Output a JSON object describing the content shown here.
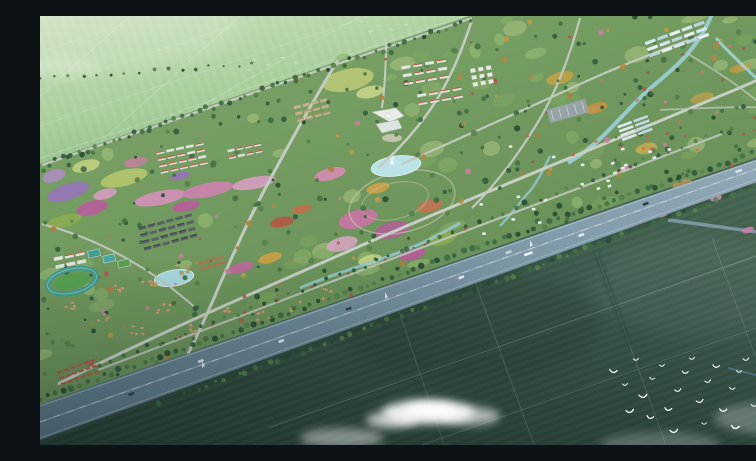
{
  "meta": {
    "title": "Aerial masterplan rendering",
    "description": "Bird's-eye architectural rendering of a large garden community surrounded by farmland, crossed diagonally by a tree-lined highway, with dark crop fields, a flock of white birds and drifting clouds in the foreground."
  },
  "palette": {
    "farmland_light": "#b7d5a5",
    "development_green": "#6f9a5c",
    "field_dark": "#32503f",
    "highway_asphalt": "#7b93a2",
    "water": "#a9dbe0",
    "cloud": "#ffffff",
    "bird": "#f5f8fa",
    "track_teal": "#3f9e8f",
    "roof_red": "#b5563c",
    "roof_dark": "#4a4f55",
    "cottage_tan": "#c8a873",
    "building_white": "#e9ede9",
    "road_light": "#c9cfc3"
  },
  "scene": {
    "clouds": [
      {
        "x": 388,
        "y": 396,
        "rx": 46,
        "ry": 12,
        "o": 0.88
      },
      {
        "x": 390,
        "y": 394,
        "rx": 26,
        "ry": 7,
        "o": 0.95
      },
      {
        "x": 352,
        "y": 404,
        "rx": 26,
        "ry": 8,
        "o": 0.7
      },
      {
        "x": 430,
        "y": 400,
        "rx": 30,
        "ry": 9,
        "o": 0.62
      },
      {
        "x": 302,
        "y": 422,
        "rx": 42,
        "ry": 10,
        "o": 0.42
      },
      {
        "x": 620,
        "y": 428,
        "rx": 60,
        "ry": 12,
        "o": 0.22
      },
      {
        "x": 732,
        "y": 402,
        "rx": 58,
        "ry": 16,
        "o": 0.26
      },
      {
        "x": 20,
        "y": 52,
        "rx": 40,
        "ry": 10,
        "o": 0.18
      }
    ],
    "birds": {
      "flock": [
        [
          573,
          356
        ],
        [
          585,
          369
        ],
        [
          596,
          344
        ],
        [
          603,
          381
        ],
        [
          612,
          363
        ],
        [
          622,
          350
        ],
        [
          628,
          394
        ],
        [
          638,
          375
        ],
        [
          645,
          357
        ],
        [
          652,
          343
        ],
        [
          660,
          386
        ],
        [
          668,
          366
        ],
        [
          676,
          351
        ],
        [
          683,
          395
        ],
        [
          692,
          373
        ],
        [
          699,
          356
        ],
        [
          706,
          344
        ],
        [
          714,
          390
        ],
        [
          722,
          371
        ],
        [
          695,
          412
        ],
        [
          664,
          408
        ],
        [
          634,
          416
        ],
        [
          610,
          402
        ],
        [
          590,
          396
        ],
        [
          735,
          345
        ],
        [
          742,
          362
        ],
        [
          730,
          385
        ]
      ],
      "distant": [
        [
          322,
          6
        ],
        [
          338,
          10
        ],
        [
          352,
          14
        ],
        [
          366,
          9
        ],
        [
          330,
          16
        ],
        [
          215,
          44
        ],
        [
          228,
          49
        ],
        [
          242,
          42
        ],
        [
          256,
          47
        ],
        [
          208,
          54
        ]
      ]
    },
    "cars": [
      {
        "x": 700,
        "lane": -1,
        "color": "#dfe8ee",
        "len": 7
      },
      {
        "x": 607,
        "lane": -1,
        "color": "#2e3c46",
        "len": 6
      },
      {
        "x": 540,
        "lane": 1,
        "color": "#e8eef2",
        "len": 6
      },
      {
        "x": 487,
        "lane": 1,
        "color": "#f0f4f6",
        "len": 9
      },
      {
        "x": 470,
        "lane": -1,
        "color": "#cfd8df",
        "len": 6
      },
      {
        "x": 420,
        "lane": 1,
        "color": "#e8eef2",
        "len": 6
      },
      {
        "x": 310,
        "lane": -1,
        "color": "#32414c",
        "len": 6
      },
      {
        "x": 240,
        "lane": 1,
        "color": "#e8eef2",
        "len": 6
      },
      {
        "x": 162,
        "lane": -1,
        "color": "#dfe8ee",
        "len": 6
      },
      {
        "x": 90,
        "lane": 1,
        "color": "#2e3c46",
        "len": 6
      }
    ],
    "masts": [
      [
        345,
        283
      ],
      [
        490,
        231
      ],
      [
        162,
        352
      ]
    ],
    "pavilions_x": [
      140,
      172,
      205,
      238,
      272,
      308,
      345,
      385,
      425
    ],
    "flowers": [
      {
        "x": 28,
        "y": 176,
        "rx": 22,
        "ry": 8,
        "rot": -18,
        "c": "#9b6fc0"
      },
      {
        "x": 14,
        "y": 160,
        "rx": 12,
        "ry": 6,
        "rot": -18,
        "c": "#b48cc9"
      },
      {
        "x": 52,
        "y": 192,
        "rx": 16,
        "ry": 7,
        "rot": -15,
        "c": "#c2559c"
      },
      {
        "x": 84,
        "y": 162,
        "rx": 24,
        "ry": 8,
        "rot": -14,
        "c": "#bccb6a"
      },
      {
        "x": 46,
        "y": 150,
        "rx": 14,
        "ry": 6,
        "rot": -14,
        "c": "#cdd67f"
      },
      {
        "x": 24,
        "y": 205,
        "rx": 18,
        "ry": 6,
        "rot": -15,
        "c": "#8fae4a"
      },
      {
        "x": 65,
        "y": 178,
        "rx": 12,
        "ry": 5,
        "rot": -15,
        "c": "#e09fc5"
      },
      {
        "x": 120,
        "y": 182,
        "rx": 26,
        "ry": 7,
        "rot": -11,
        "c": "#df8fc0"
      },
      {
        "x": 168,
        "y": 174,
        "rx": 26,
        "ry": 7,
        "rot": -11,
        "c": "#d77fb5"
      },
      {
        "x": 214,
        "y": 167,
        "rx": 22,
        "ry": 6,
        "rot": -11,
        "c": "#e39fc9"
      },
      {
        "x": 146,
        "y": 190,
        "rx": 14,
        "ry": 5,
        "rot": -11,
        "c": "#c2559c"
      },
      {
        "x": 242,
        "y": 206,
        "rx": 12,
        "ry": 5,
        "rot": -12,
        "c": "#bf4f3f"
      },
      {
        "x": 262,
        "y": 193,
        "rx": 10,
        "ry": 4,
        "rot": -12,
        "c": "#c96a43"
      },
      {
        "x": 318,
        "y": 203,
        "rx": 20,
        "ry": 9,
        "rot": -14,
        "c": "#d36fa8"
      },
      {
        "x": 352,
        "y": 214,
        "rx": 18,
        "ry": 8,
        "rot": -14,
        "c": "#b85a9b"
      },
      {
        "x": 302,
        "y": 228,
        "rx": 16,
        "ry": 7,
        "rot": -14,
        "c": "#e2a4c6"
      },
      {
        "x": 390,
        "y": 190,
        "rx": 13,
        "ry": 6,
        "rot": -14,
        "c": "#cf6f4f"
      },
      {
        "x": 338,
        "y": 172,
        "rx": 12,
        "ry": 5,
        "rot": -14,
        "c": "#d9a23f"
      },
      {
        "x": 402,
        "y": 222,
        "rx": 15,
        "ry": 7,
        "rot": -14,
        "c": "#8fae4a"
      },
      {
        "x": 372,
        "y": 238,
        "rx": 14,
        "ry": 6,
        "rot": -14,
        "c": "#c2559c"
      },
      {
        "x": 330,
        "y": 244,
        "rx": 12,
        "ry": 5,
        "rot": -14,
        "c": "#cdd67f"
      },
      {
        "x": 290,
        "y": 158,
        "rx": 16,
        "ry": 6,
        "rot": -14,
        "c": "#e08bb8"
      },
      {
        "x": 200,
        "y": 252,
        "rx": 14,
        "ry": 5,
        "rot": -16,
        "c": "#c9619f"
      },
      {
        "x": 230,
        "y": 242,
        "rx": 12,
        "ry": 5,
        "rot": -16,
        "c": "#d9a23f"
      },
      {
        "x": 520,
        "y": 62,
        "rx": 14,
        "ry": 6,
        "rot": -16,
        "c": "#c9a23f"
      },
      {
        "x": 556,
        "y": 92,
        "rx": 12,
        "ry": 5,
        "rot": -16,
        "c": "#cf8f3f"
      },
      {
        "x": 606,
        "y": 132,
        "rx": 11,
        "ry": 5,
        "rot": -16,
        "c": "#c9a94a"
      },
      {
        "x": 662,
        "y": 82,
        "rx": 12,
        "ry": 5,
        "rot": -16,
        "c": "#b8a04a"
      },
      {
        "x": 700,
        "y": 52,
        "rx": 11,
        "ry": 4,
        "rot": -16,
        "c": "#c49a3f"
      },
      {
        "x": 642,
        "y": 168,
        "rx": 10,
        "ry": 4,
        "rot": -16,
        "c": "#bf8f4f"
      },
      {
        "x": 586,
        "y": 152,
        "rx": 7,
        "ry": 3,
        "rot": -16,
        "c": "#dc8fb5"
      },
      {
        "x": 622,
        "y": 198,
        "rx": 7,
        "ry": 3,
        "rot": -16,
        "c": "#d993b8"
      },
      {
        "x": 676,
        "y": 182,
        "rx": 6,
        "ry": 3,
        "rot": -16,
        "c": "#dc8fb5"
      },
      {
        "x": 708,
        "y": 214,
        "rx": 6,
        "ry": 3,
        "rot": -16,
        "c": "#d07fae"
      },
      {
        "x": 308,
        "y": 64,
        "rx": 26,
        "ry": 11,
        "rot": -12,
        "c": "#c2cc72"
      },
      {
        "x": 330,
        "y": 76,
        "rx": 14,
        "ry": 6,
        "rot": -12,
        "c": "#d3d98a"
      },
      {
        "x": 96,
        "y": 146,
        "rx": 12,
        "ry": 5,
        "rot": -12,
        "c": "#c77f9f"
      },
      {
        "x": 140,
        "y": 160,
        "rx": 10,
        "ry": 4,
        "rot": -12,
        "c": "#9b6fc0"
      }
    ],
    "building_clusters": [
      {
        "cx": 385,
        "cy": 56,
        "rot": -10,
        "rows": 3,
        "cols": 4,
        "w": 9,
        "h": 3,
        "gx": 12,
        "gy": 8,
        "fill": "#e7eae5",
        "accent": "#b5563c"
      },
      {
        "cx": 400,
        "cy": 80,
        "rot": -10,
        "rows": 2,
        "cols": 4,
        "w": 9,
        "h": 3,
        "gx": 12,
        "gy": 8,
        "fill": "#e2e6e1",
        "accent": "#b5563c"
      },
      {
        "cx": 442,
        "cy": 60,
        "rot": -10,
        "rows": 3,
        "cols": 3,
        "w": 5,
        "h": 4,
        "gx": 8,
        "gy": 7,
        "fill": "#eceeea",
        "accent": null
      },
      {
        "cx": 272,
        "cy": 94,
        "rot": -14,
        "rows": 3,
        "cols": 4,
        "w": 7,
        "h": 3,
        "gx": 9,
        "gy": 6.5,
        "fill": "#cbb089",
        "accent": "#a98f66"
      },
      {
        "cx": 142,
        "cy": 142,
        "rot": -12,
        "rows": 4,
        "cols": 5,
        "w": 8,
        "h": 2.6,
        "gx": 10,
        "gy": 6.5,
        "fill": "#e3e6e0",
        "accent": "#b5563c"
      },
      {
        "cx": 205,
        "cy": 135,
        "rot": -12,
        "rows": 2,
        "cols": 4,
        "w": 7,
        "h": 2.6,
        "gx": 9,
        "gy": 7,
        "fill": "#dfe3dd",
        "accent": "#b5563c"
      },
      {
        "cx": 128,
        "cy": 216,
        "rot": -15,
        "rows": 4,
        "cols": 6,
        "w": 7.5,
        "h": 3,
        "gx": 9.5,
        "gy": 7,
        "fill": "#585d62",
        "accent": "#3e4347"
      },
      {
        "cx": 30,
        "cy": 244,
        "rot": -12,
        "rows": 2,
        "cols": 3,
        "w": 9,
        "h": 3.5,
        "gx": 11,
        "gy": 8,
        "fill": "#e6e9e4",
        "accent": "#b5563c"
      },
      {
        "cx": 38,
        "cy": 356,
        "rot": -19,
        "rows": 3,
        "cols": 6,
        "w": 5,
        "h": 2.2,
        "gx": 7,
        "gy": 6,
        "fill": "#b5563c",
        "accent": null
      },
      {
        "cx": 172,
        "cy": 247,
        "rot": -16,
        "rows": 2,
        "cols": 4,
        "w": 5.5,
        "h": 2.3,
        "gx": 7,
        "gy": 5.5,
        "fill": "#bf6a4a",
        "accent": null
      }
    ],
    "building_scatters": [
      {
        "x": 438,
        "y": 118,
        "w": 190,
        "h": 100,
        "n": 34,
        "size": 3.6,
        "fill": "#e9ede8",
        "accent": "#c06a4a"
      },
      {
        "x": 480,
        "y": 16,
        "w": 250,
        "h": 130,
        "n": 26,
        "size": 3.2,
        "fill": "#c9785a",
        "accent": "#a85a42"
      }
    ],
    "cottage_clusters": [
      [
        30,
        290
      ],
      [
        62,
        300
      ],
      [
        96,
        312
      ],
      [
        76,
        272
      ],
      [
        122,
        292
      ],
      [
        152,
        312
      ],
      [
        188,
        296
      ],
      [
        222,
        300
      ],
      [
        256,
        290
      ],
      [
        288,
        277
      ],
      [
        105,
        268
      ],
      [
        140,
        252
      ]
    ],
    "greenhouses": [
      {
        "cx": 637,
        "cy": 23,
        "rows": 3,
        "cols": 5,
        "w": 11,
        "h": 3.2,
        "gx": 13,
        "gy": 6.5,
        "rot": -20,
        "colors": [
          "#dce9f0",
          "#c2d6e4",
          "#eef4f7"
        ]
      },
      {
        "cx": 595,
        "cy": 112,
        "rows": 4,
        "cols": 2,
        "w": 15,
        "h": 2.6,
        "gx": 17,
        "gy": 4.5,
        "rot": -20,
        "colors": [
          "#e4edf2",
          "#cadbe6"
        ]
      }
    ]
  }
}
